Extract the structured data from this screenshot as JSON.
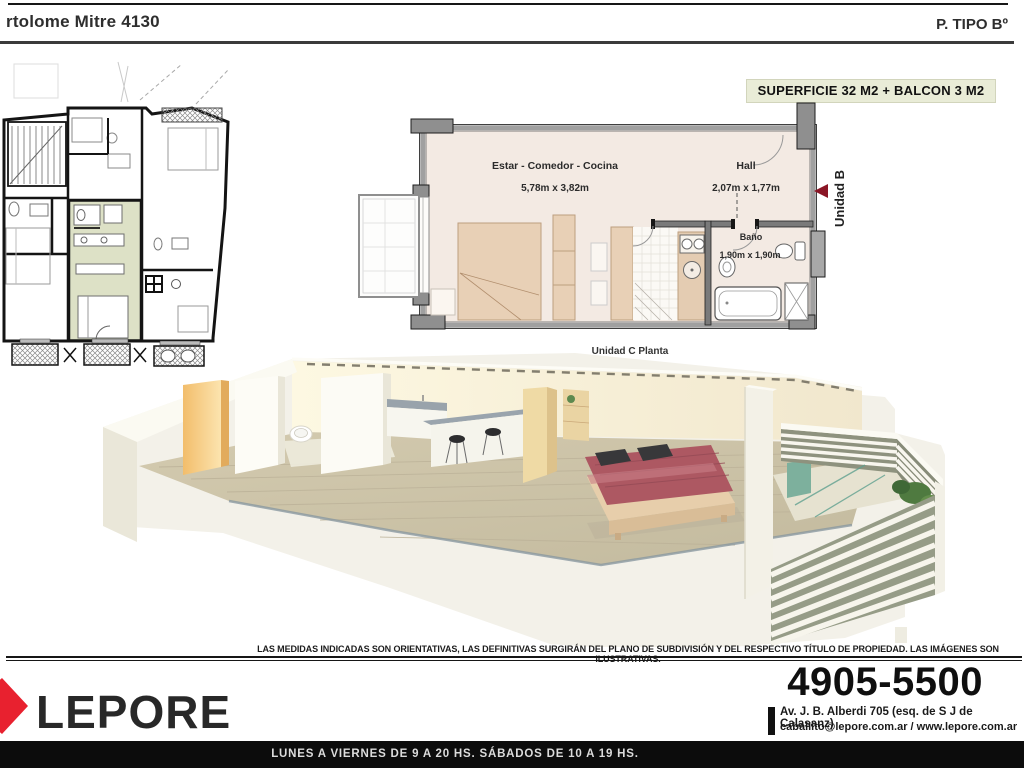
{
  "header": {
    "title": "rtolome Mitre 4130",
    "plan_type": "P. TIPO Bº"
  },
  "badge": {
    "label": "SUPERFICIE 32 M2 + BALCON 3 M2"
  },
  "unit_plan": {
    "rooms": [
      {
        "name": "Estar - Comedor - Cocina",
        "dims": "5,78m x 3,82m"
      },
      {
        "name": "Hall",
        "dims": "2,07m x 1,77m"
      },
      {
        "name": "Baño",
        "dims": "1,90m x 1,90m"
      }
    ],
    "unit_marker": "Unidad B",
    "caption": "Unidad C Planta"
  },
  "colors": {
    "badge_bg": "#e9ecd7",
    "highlighted_unit": "#dde1c6",
    "marker_arrow": "#8b1626",
    "brand_red": "#e8212f"
  },
  "disclaimer": "LAS MEDIDAS INDICADAS SON ORIENTATIVAS, LAS DEFINITIVAS SURGIRÁN DEL PLANO DE SUBDIVISIÓN Y DEL RESPECTIVO TÍTULO DE PROPIEDAD. LAS IMÁGENES SON ILUSTRATIVAS.",
  "footer": {
    "brand": "LEPORE",
    "phone": "4905-5500",
    "address": "Av. J. B. Alberdi 705 (esq. de S J de Calasanz)",
    "web": "caballito@lepore.com.ar / www.lepore.com.ar",
    "hours": "LUNES A VIERNES DE 9 A 20 HS. SÁBADOS DE 10 A 19 HS."
  }
}
